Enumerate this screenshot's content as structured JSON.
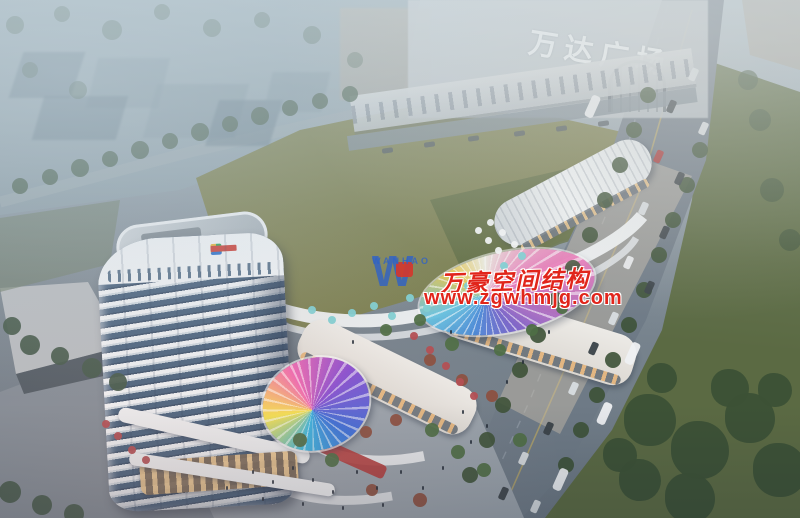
{
  "signs": {
    "mall": "万达广场"
  },
  "watermark": {
    "logo_letter": "W",
    "logo_name": "WANHAO",
    "company": "万豪空间结构",
    "url": "www.zgwhmjg.com"
  },
  "colors": {
    "sign_white": "#f2f6f8",
    "watermark_red": "#e1251b",
    "watermark_blue": "#2f62c8",
    "lawn": "#7b7f50",
    "lawn_shadow": "#5e6b41",
    "avenue": "#6e7a86",
    "lane_yellow": "#c9b05e",
    "tower_white": "#eef2f5",
    "tower_glass": "#46617d",
    "retail_white": "#e9e6e2",
    "storefront_glow": "#e3b073",
    "accent_red_band": "#b03a3a",
    "umbrella_teal": "#7ecfd2",
    "umbrella_red": "#b24d52",
    "tree_dark": "#3c5136",
    "tree_mid": "#4c6351",
    "tree_autumn": "#8a4f3f",
    "canopy_rainbow": [
      "#e8c84f",
      "#f0efe6",
      "#ea78b8",
      "#7a62c8",
      "#4a8ad8",
      "#66c2e0"
    ]
  }
}
